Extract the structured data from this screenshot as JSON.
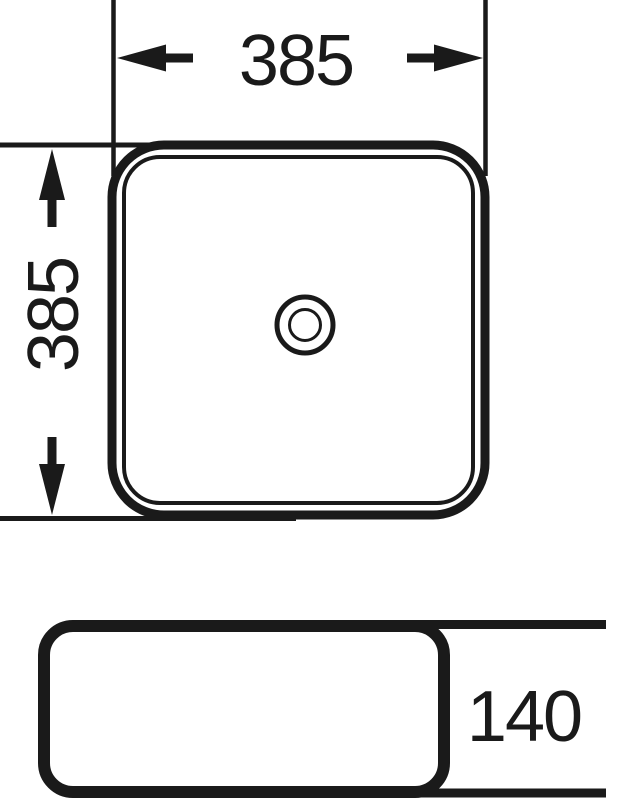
{
  "drawing": {
    "background_color": "#ffffff",
    "line_color": "#1a1a1a",
    "dimensions": {
      "width_label": "385",
      "depth_label": "385",
      "height_label": "140"
    }
  }
}
